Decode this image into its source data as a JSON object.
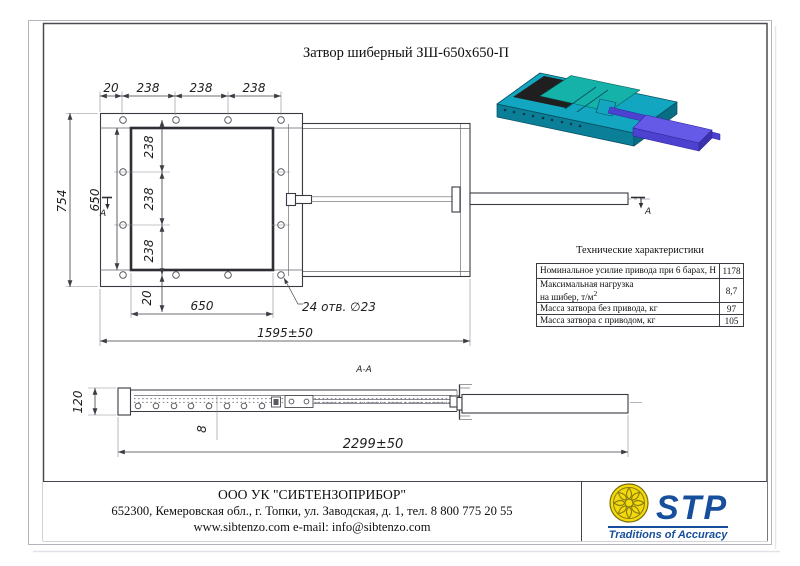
{
  "drawing": {
    "title": "Затвор шиберный ЗШ-650х650-П",
    "views": {
      "section_label": "А-А",
      "cut_marker": "А"
    },
    "dims": {
      "top_chain": [
        "20",
        "238",
        "238",
        "238"
      ],
      "overall_height": "754",
      "opening_height": "650",
      "left_chain": [
        "238",
        "238",
        "238"
      ],
      "bottom_offset": "20",
      "opening_width": "650",
      "holes_note": "24 отв. ∅23",
      "frame_length": "1595±50",
      "profile_height": "120",
      "plate_thickness": "8",
      "overall_length": "2299±50"
    }
  },
  "tech_table": {
    "title": "Технические характеристики",
    "rows": [
      {
        "label": "Номинальное усилие привода при 6 барах, Н",
        "value": "1178"
      },
      {
        "line1": "Максимальная нагрузка",
        "line2": "на шибер, т/м",
        "sup": "2",
        "value": "8,7"
      },
      {
        "label": "Масса затвора без привода, кг",
        "value": "97"
      },
      {
        "label": "Масса затвора с приводом, кг",
        "value": "105"
      }
    ]
  },
  "footer": {
    "company": "ООО УК \"СИБТЕНЗОПРИБОР\"",
    "address": "652300, Кемеровская обл., г. Топки, ул. Заводская, д. 1, тел. 8 800 775 20 55",
    "web": "www.sibtenzo.com e-mail: info@sibtenzo.com",
    "logo_text": "STP",
    "logo_tagline": "Traditions of Accuracy"
  },
  "colors": {
    "body_teal": "#12a6c0",
    "body_teal_dark": "#0b7e98",
    "gate_teal": "#15b2aa",
    "actuator_purple": "#655ae8",
    "actuator_purple_dark": "#4d41cf",
    "logo_blue": "#174f9c",
    "logo_yellow": "#f4d90c"
  }
}
